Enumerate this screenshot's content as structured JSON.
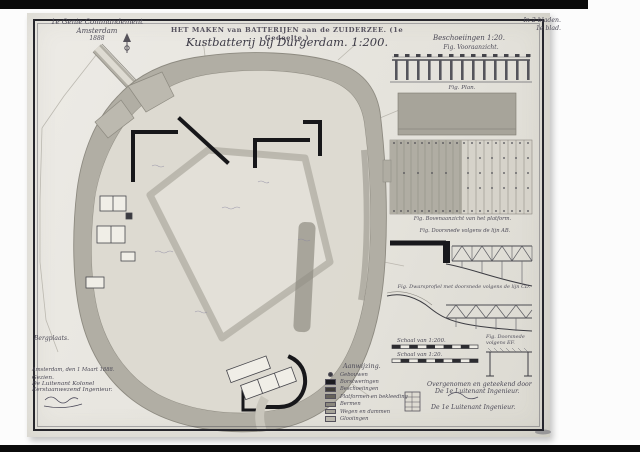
{
  "photo": {
    "background": "#fcfcfc",
    "border_bar_color": "#0b0b0b",
    "paper_color": "#e8e6e0",
    "ink_color": "#4b4956",
    "parapet_color": "#17171a"
  },
  "header_left": {
    "line1": "1e Genie Commandement",
    "line2": "Amsterdam",
    "line3": "1888"
  },
  "title": {
    "line1": "HET MAKEN van BATTERIJEN aan de ZUIDERZEE. (1e Gedeelte.)",
    "line2": "Kustbatterij bij Durgerdam. 1:200."
  },
  "header_right": {
    "line1": "Beschoeiingen 1:20.",
    "line2": "Fig. Vooraanzicht."
  },
  "sheet_no": {
    "line1": "In 2 bladen.",
    "line2": "1e blad."
  },
  "plan": {
    "annotation": "Bergplaats."
  },
  "figures": {
    "plan_caption": "Fig. Plan.",
    "platform_caption": "Fig. Bovenaanzicht van het platform.",
    "xsec1_caption": "Fig. Doorsnede volgens de lijn AB.",
    "xsec2_caption": "Fig. Dwarsprofiel met doorsnede volgens de lijn CD.",
    "bench_caption_1": "Fig. Doorsnede",
    "bench_caption_2": "volgens EF."
  },
  "scalebars": {
    "bar1_label": "Schaal van 1:200.",
    "bar2_label": "Schaal van 1:20."
  },
  "legend": {
    "title": "Aanwijzing.",
    "items": [
      {
        "label": "Gebouwen",
        "color": "#3a3a40"
      },
      {
        "label": "Borstweringen",
        "color": "#1c1c20"
      },
      {
        "label": "Beschoeiingen",
        "color": "#3f3d38"
      },
      {
        "label": "Platformen  en  bekleeding",
        "color": "#66635a"
      },
      {
        "label": "Bermen",
        "color": "#8a877d"
      },
      {
        "label": "Wegen en dammen",
        "color": "#a5a298"
      },
      {
        "label": "Glooiingen",
        "color": "#bbb8ae"
      }
    ]
  },
  "signatures_right": {
    "line1": "Overgenomen en geteekend door",
    "line2": "De 1e Luitenant Ingenieur.",
    "line3": "De 1e Luitenant Ingenieur."
  },
  "bottom_left": {
    "line1": "Amsterdam, den 1 Maart 1888.",
    "line2": "Gezien.",
    "line3": "De Luitenant Kolonel",
    "line4": "Eerstaanwezend Ingenieur."
  }
}
